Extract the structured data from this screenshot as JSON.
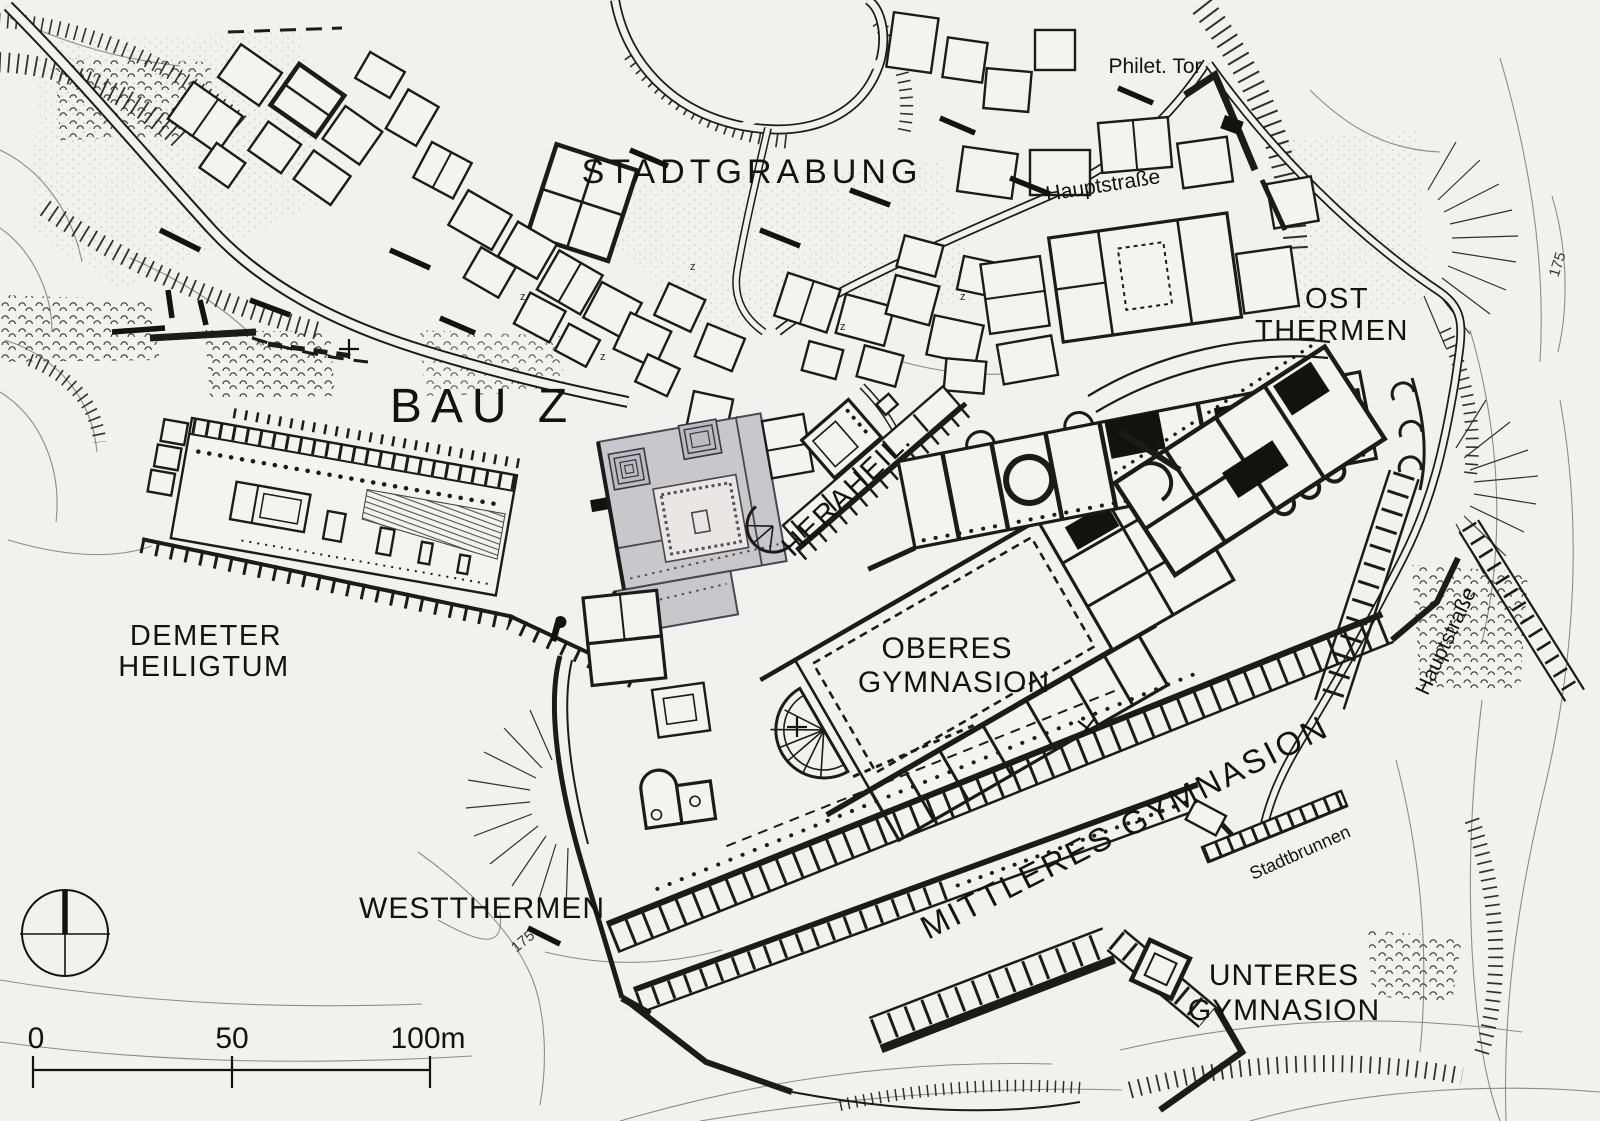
{
  "map": {
    "labels": {
      "stadtgrabung": "STADTGRABUNG",
      "philet_tor": "Philet. Tor",
      "hauptstrasse_top": "Hauptstraße",
      "ost_1": "OST",
      "ost_2": "THERMEN",
      "bau_z": "BAU Z",
      "heraheil": "HERAHEIL.",
      "demeter_1": "DEMETER",
      "demeter_2": "HEILIGTUM",
      "oberes_1": "OBERES",
      "oberes_2": "GYMNASION",
      "mittleres": "MITTLERES GYMNASION",
      "westthermen": "WESTTHERMEN",
      "unteres_1": "UNTERES",
      "unteres_2": "GYMNASION",
      "stadtbrunnen": "Stadtbrunnen",
      "hauptstrasse_right": "Hauptstraße",
      "c175_west": "175",
      "c175_east": "175",
      "z_marker": "z"
    },
    "scale_bar": {
      "tick0": "0",
      "tick50": "50",
      "tick100": "100m"
    },
    "colors": {
      "paper": "#f3f1ee",
      "ink": "#1d1b18",
      "contour": "#8f8b84",
      "bau_z_fill": "#c9c6cc",
      "bau_z_court": "#e9e6e4"
    }
  }
}
